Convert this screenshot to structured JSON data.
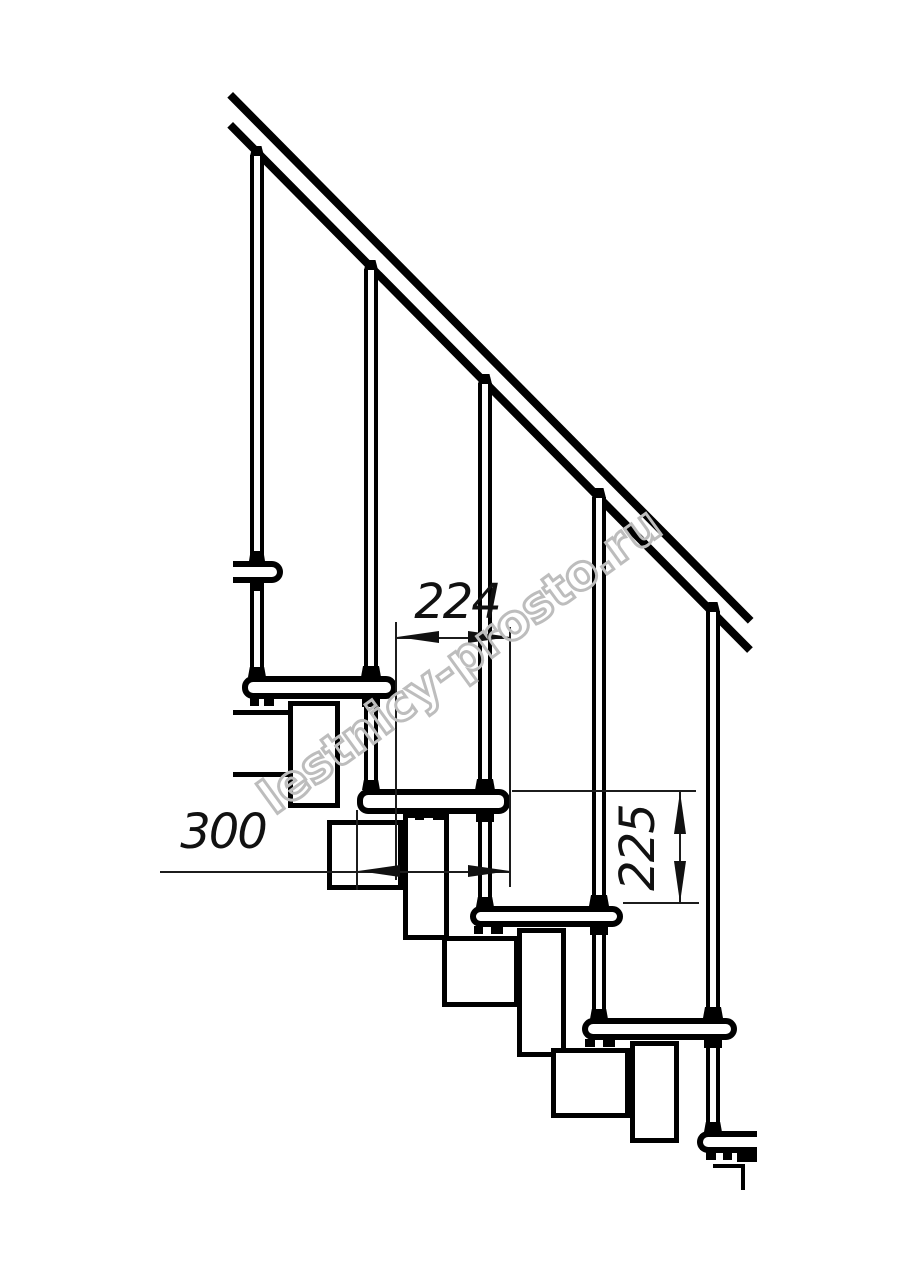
{
  "drawing": {
    "kind": "modular staircase side elevation",
    "colors": {
      "line": "#000000",
      "dimension": "#1c1c1c",
      "watermark": "#bdbdbd",
      "background": "#ffffff"
    }
  },
  "dimensions": {
    "step_run_label": "224",
    "tread_depth_label": "300",
    "riser_height_label": "225"
  },
  "watermark": {
    "text": "lestnicy-prosto.ru"
  }
}
